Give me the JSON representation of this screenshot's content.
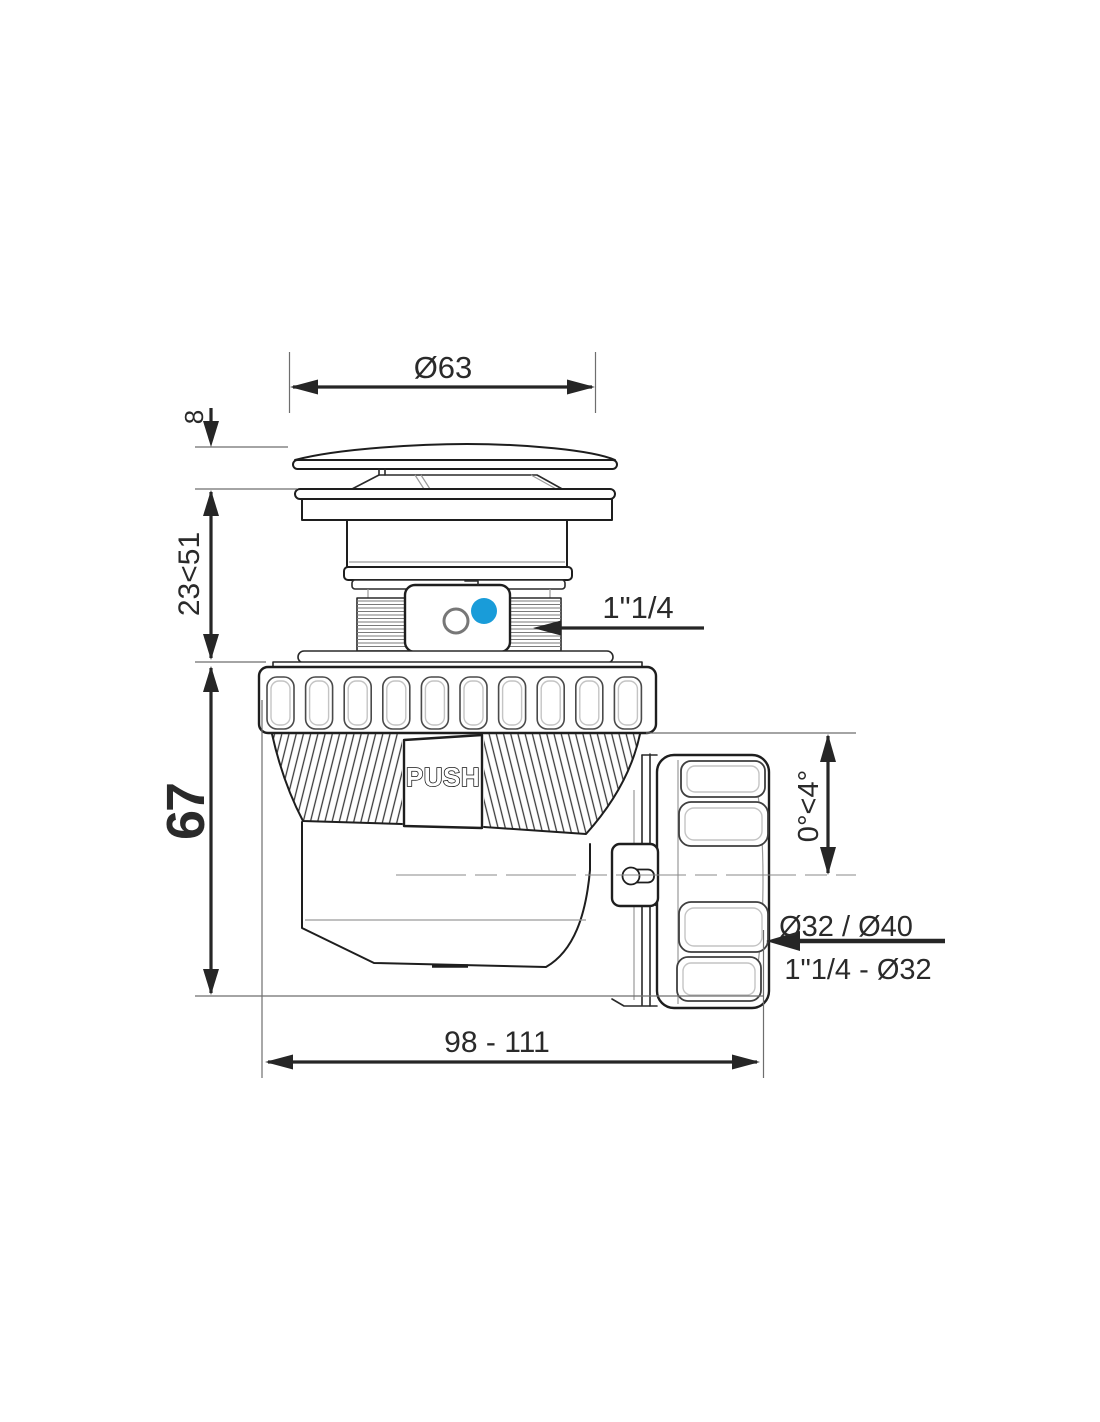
{
  "drawing": {
    "labels": {
      "cap_diameter": "Ø63",
      "cap_height": "8",
      "install_range": "23<51",
      "body_height": "67",
      "inlet_thread": "1\"1/4",
      "push_button": "PUSH",
      "outlet_angle": "0°<4°",
      "outlet_diameters": "Ø32 / Ø40",
      "outlet_thread": "1\"1/4 - Ø32",
      "overall_length": "98 - 111"
    },
    "colors": {
      "line": "#1e1e1e",
      "dimension": "#262626",
      "light_line": "#9a9a9a",
      "accent_blue": "#199cd9"
    }
  }
}
